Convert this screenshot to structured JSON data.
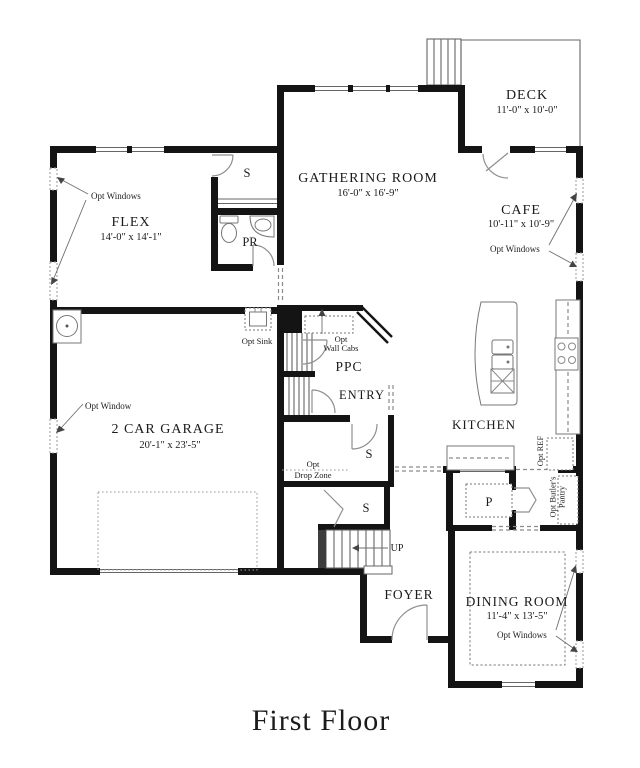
{
  "title": "First Floor",
  "rooms": {
    "flex": {
      "name": "FLEX",
      "dims": "14'-0\" x 14'-1\""
    },
    "gathering": {
      "name": "GATHERING ROOM",
      "dims": "16'-0\" x 16'-9\""
    },
    "deck": {
      "name": "DECK",
      "dims": "11'-0\" x 10'-0\""
    },
    "cafe": {
      "name": "CAFE",
      "dims": "10'-11\" x 10'-9\""
    },
    "kitchen": {
      "name": "KITCHEN"
    },
    "garage": {
      "name": "2 CAR GARAGE",
      "dims": "20'-1\" x 23'-5\""
    },
    "dining": {
      "name": "DINING ROOM",
      "dims": "11'-4\" x 13'-5\""
    },
    "foyer": {
      "name": "FOYER"
    },
    "entry": {
      "name": "ENTRY"
    },
    "ppc": {
      "name": "PPC"
    },
    "powder": {
      "name": "PR"
    }
  },
  "markers": {
    "closet": "S",
    "pantry": "P",
    "up": "UP",
    "dishwasher": "DW"
  },
  "options": {
    "opt_windows": "Opt Windows",
    "opt_window": "Opt Window",
    "opt_sink": "Opt Sink",
    "opt_wall_cabs_line1": "Opt",
    "opt_wall_cabs_line2": "Wall Cabs",
    "opt_drop_zone_line1": "Opt",
    "opt_drop_zone_line2": "Drop Zone",
    "opt_ref": "Opt REF",
    "opt_butlers_line1": "Opt Butler's",
    "opt_butlers_line2": "Pantry"
  }
}
